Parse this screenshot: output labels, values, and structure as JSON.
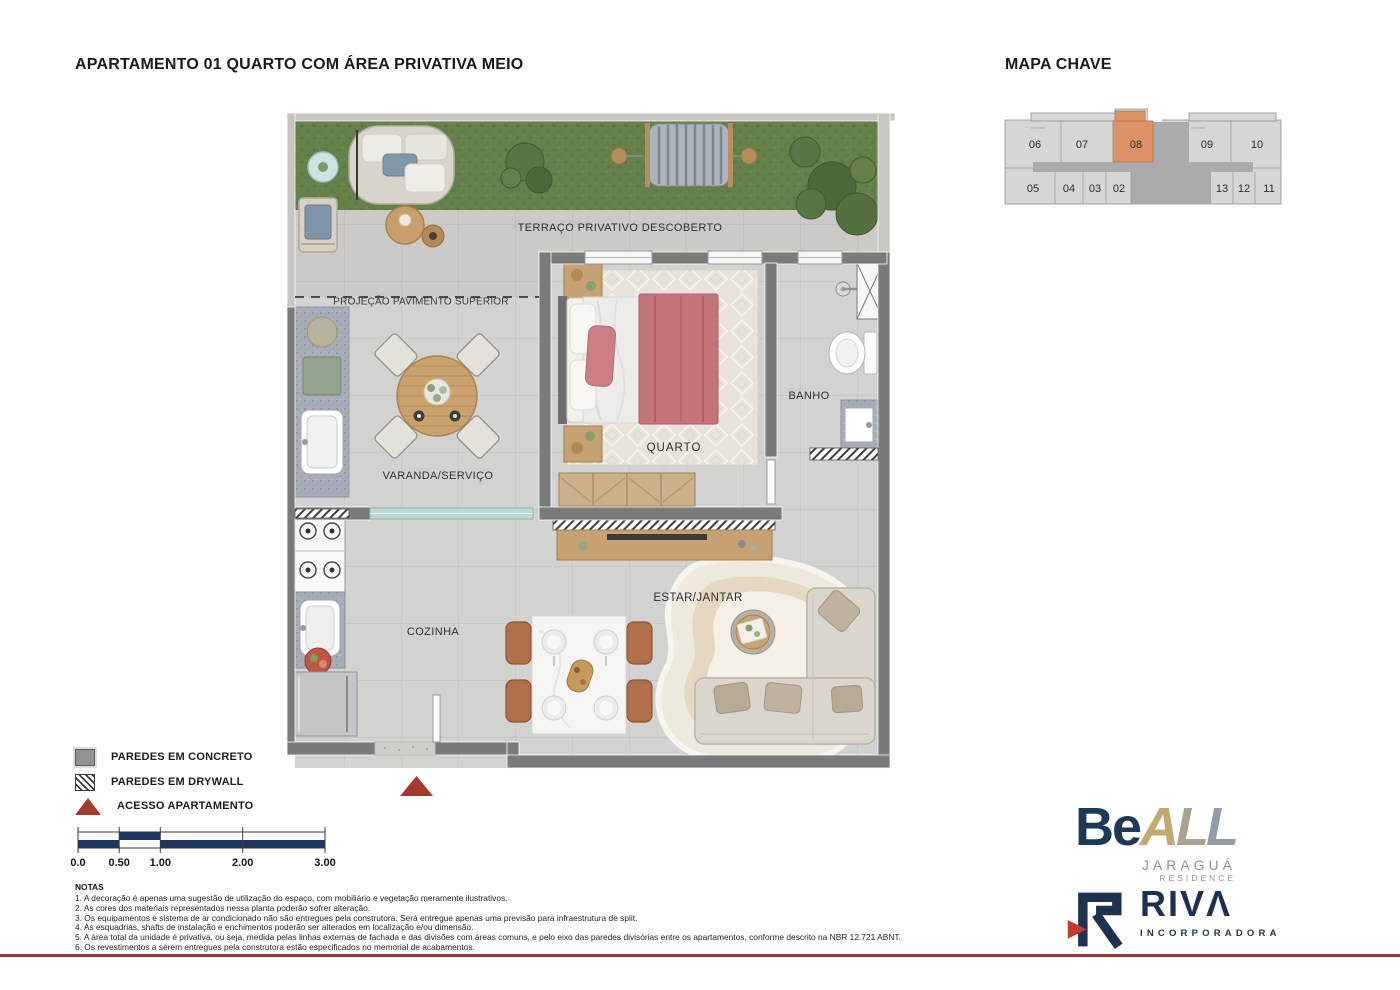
{
  "page": {
    "title": "APARTAMENTO 01 QUARTO COM ÁREA PRIVATIVA MEIO",
    "map_title": "MAPA CHAVE"
  },
  "key_map": {
    "highlighted_unit": "08",
    "highlight_color": "#DC9265",
    "top_units": [
      "06",
      "07",
      "08",
      "09",
      "10"
    ],
    "bottom_units": [
      "05",
      "04",
      "03",
      "02",
      "13",
      "12",
      "11"
    ]
  },
  "plan": {
    "labels": {
      "terraco": "TERRAÇO PRIVATIVO DESCOBERTO",
      "projecao": "PROJEÇÃO PAVIMENTO SUPERIOR",
      "quarto": "QUARTO",
      "banho": "BANHO",
      "varanda": "VARANDA/SERVIÇO",
      "cozinha": "COZINHA",
      "estar": "ESTAR/JANTAR"
    },
    "colors": {
      "wall_concrete": "#7A7A7B",
      "grass": "#65804B",
      "access_triangle": "#A33A2C"
    }
  },
  "legend": {
    "concrete": "PAREDES EM CONCRETO",
    "drywall": "PAREDES EM DRYWALL",
    "access": "ACESSO APARTAMENTO"
  },
  "scale_bar": {
    "ticks": [
      "0.0",
      "0.50",
      "1.00",
      "2.00",
      "3.00"
    ]
  },
  "notes": {
    "header": "NOTAS",
    "items": [
      "1. A decoração é apenas uma sugestão de utilização do espaço, com mobiliário e vegetação meramente ilustrativos.",
      "2. As cores dos materiais representados nessa planta poderão sofrer alteração.",
      "3. Os equipamentos e sistema de ar condicionado não são entregues pela construtora. Será entregue apenas uma previsão para infraestrutura de split.",
      "4. As esquadrias, shafts de instalação e enchimentos poderão ser alterados em localização e/ou dimensão.",
      "5. A área total da unidade é privativa, ou seja, medida pelas linhas externas de fachada e das divisões com áreas comuns, e pelo eixo das paredes divisórias entre os apartamentos, conforme descrito na NBR 12.721 ABNT.",
      "6. Os revestimentos a serem entregues pela construtora estão especificados no memorial de acabamentos."
    ]
  },
  "logos": {
    "beall": {
      "be": "Be",
      "letters": [
        "A",
        "L",
        "L"
      ],
      "sub1": "JARAGUÁ",
      "sub2": "RESIDENCE",
      "navy": "#1C3A57"
    },
    "riva": {
      "name": "RIVΛ",
      "sub": "INCORPORADORA",
      "navy": "#1F3150",
      "red": "#C23B33"
    }
  }
}
